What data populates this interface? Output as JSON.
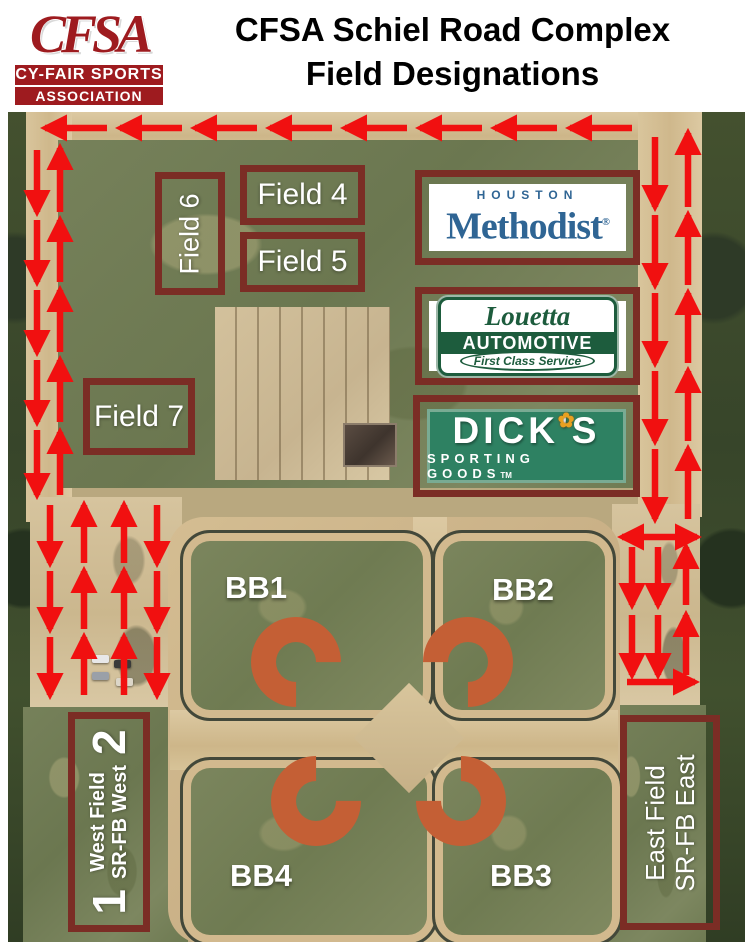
{
  "header": {
    "logo_acronym": "CFSA",
    "logo_line2": "CY-FAIR SPORTS",
    "logo_line3": "ASSOCIATION",
    "title_line1": "CFSA Schiel Road Complex",
    "title_line2": "Field Designations"
  },
  "map": {
    "field_boxes": [
      {
        "id": "field-6",
        "label": "Field 6",
        "orientation": "vertical"
      },
      {
        "id": "field-4",
        "label": "Field 4",
        "orientation": "horizontal"
      },
      {
        "id": "field-5",
        "label": "Field 5",
        "orientation": "horizontal"
      },
      {
        "id": "field-7",
        "label": "Field 7",
        "orientation": "horizontal"
      }
    ],
    "ball_fields": [
      "BB1",
      "BB2",
      "BB3",
      "BB4"
    ],
    "west_box": {
      "number_top": "2",
      "line1": "West Field",
      "line2": "SR-FB West",
      "number_bottom": "1"
    },
    "east_box": {
      "line1": "East Field",
      "line2": "SR-FB East"
    },
    "sponsors": [
      {
        "id": "houston-methodist",
        "line1": "HOUSTON",
        "line2": "Methodist",
        "mark": "®"
      },
      {
        "id": "louetta-automotive",
        "line1": "Louetta",
        "line2": "AUTOMOTIVE",
        "line3": "First Class Service"
      },
      {
        "id": "dicks-sporting-goods",
        "line1": "DICK'S",
        "line2": "SPORTING GOODS",
        "mark": "TM",
        "flower_icon": "✿"
      }
    ],
    "arrows": [
      [
        107,
        128,
        45,
        128
      ],
      [
        182,
        128,
        120,
        128
      ],
      [
        257,
        128,
        195,
        128
      ],
      [
        332,
        128,
        270,
        128
      ],
      [
        407,
        128,
        345,
        128
      ],
      [
        482,
        128,
        420,
        128
      ],
      [
        557,
        128,
        495,
        128
      ],
      [
        632,
        128,
        570,
        128
      ],
      [
        37,
        150,
        37,
        212
      ],
      [
        37,
        220,
        37,
        282
      ],
      [
        37,
        290,
        37,
        352
      ],
      [
        37,
        360,
        37,
        422
      ],
      [
        37,
        430,
        37,
        495
      ],
      [
        60,
        212,
        60,
        148
      ],
      [
        60,
        282,
        60,
        220
      ],
      [
        60,
        352,
        60,
        290
      ],
      [
        60,
        422,
        60,
        360
      ],
      [
        60,
        495,
        60,
        432
      ],
      [
        50,
        505,
        50,
        563
      ],
      [
        50,
        571,
        50,
        629
      ],
      [
        50,
        637,
        50,
        695
      ],
      [
        84,
        563,
        84,
        505
      ],
      [
        84,
        629,
        84,
        571
      ],
      [
        84,
        695,
        84,
        637
      ],
      [
        124,
        563,
        124,
        505
      ],
      [
        124,
        629,
        124,
        571
      ],
      [
        124,
        695,
        124,
        637
      ],
      [
        157,
        505,
        157,
        563
      ],
      [
        157,
        571,
        157,
        629
      ],
      [
        157,
        637,
        157,
        695
      ],
      [
        655,
        137,
        655,
        207
      ],
      [
        655,
        215,
        655,
        285
      ],
      [
        655,
        293,
        655,
        363
      ],
      [
        655,
        371,
        655,
        441
      ],
      [
        655,
        449,
        655,
        519
      ],
      [
        688,
        207,
        688,
        133
      ],
      [
        688,
        285,
        688,
        215
      ],
      [
        688,
        363,
        688,
        293
      ],
      [
        688,
        441,
        688,
        371
      ],
      [
        688,
        519,
        688,
        449
      ],
      [
        622,
        537,
        697,
        537,
        "both"
      ],
      [
        632,
        547,
        632,
        605
      ],
      [
        632,
        615,
        632,
        675
      ],
      [
        658,
        547,
        658,
        605
      ],
      [
        658,
        615,
        658,
        675
      ],
      [
        686,
        605,
        686,
        547
      ],
      [
        686,
        675,
        686,
        615
      ],
      [
        627,
        682,
        695,
        682
      ]
    ]
  },
  "theme": {
    "maroon": "#7b2d25",
    "arrow_red": "#f11010",
    "logo_red": "#9e1b1f",
    "methodist_blue": "#2f6594",
    "louetta_green": "#1d5c3d",
    "dicks_green": "#2e8162",
    "dicks_frame": "#79ab93"
  }
}
